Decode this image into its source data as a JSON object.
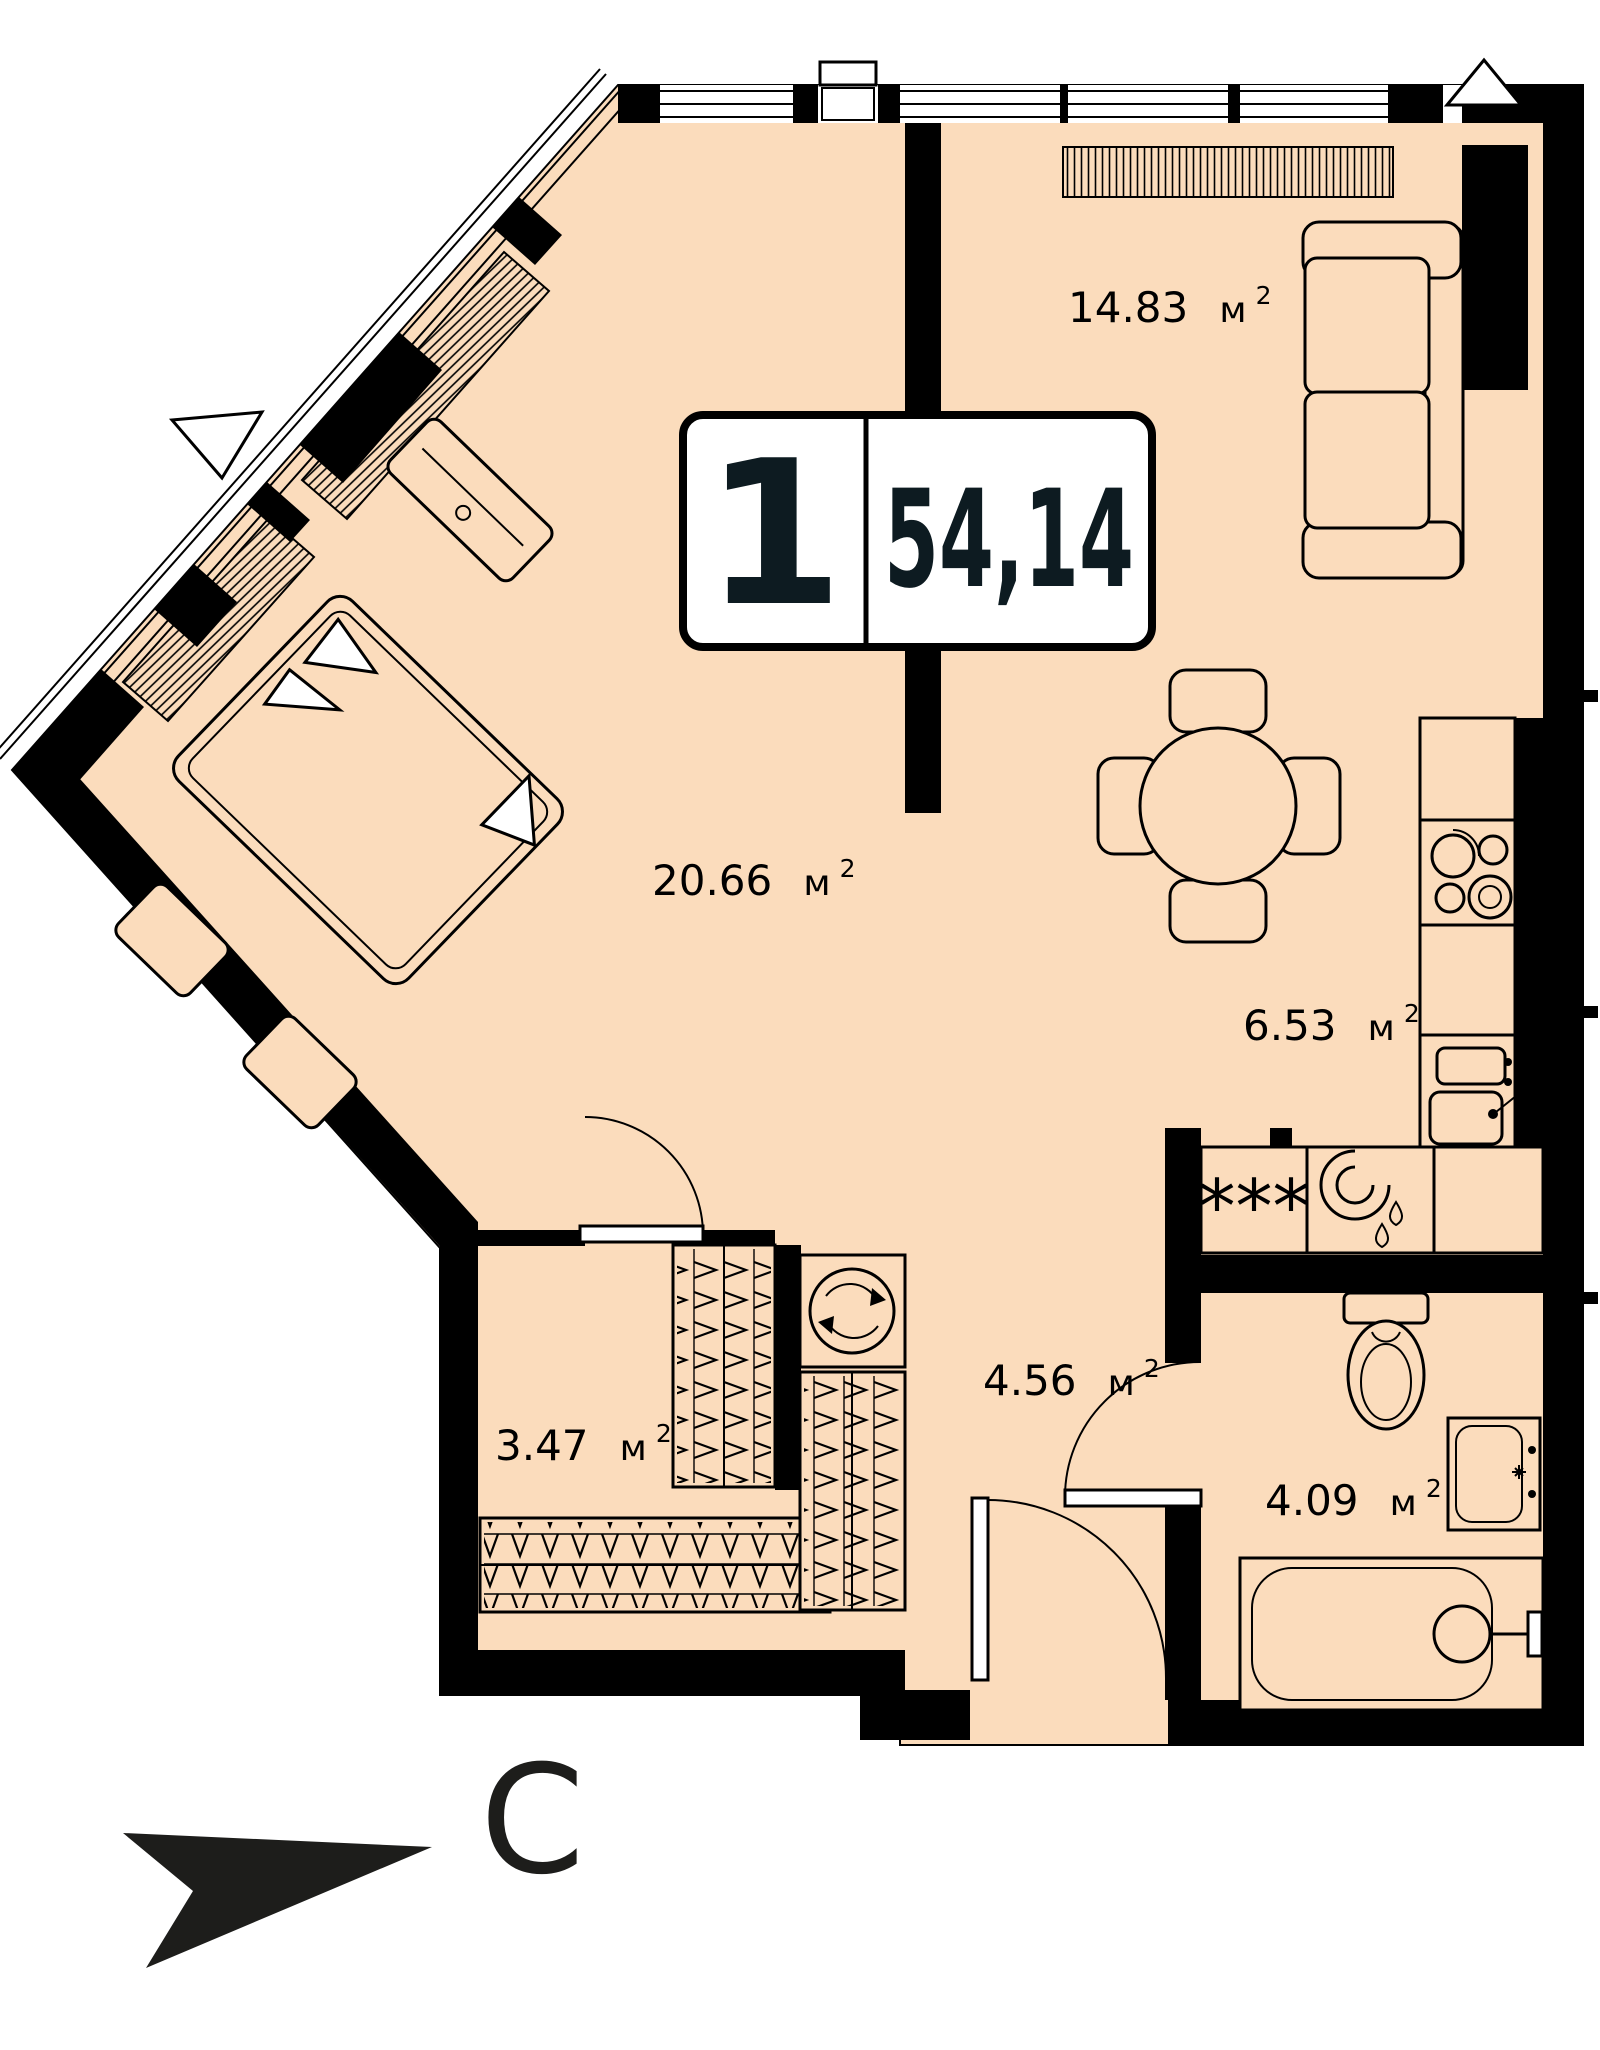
{
  "plan_title": "1-room apartment floor plan",
  "badge": {
    "rooms_count": "1",
    "total_area": "54,14"
  },
  "unit": {
    "symbol": "м",
    "power": "2"
  },
  "rooms": {
    "living": {
      "area": "14.83"
    },
    "bedroom": {
      "area": "20.66"
    },
    "kitchen": {
      "area": "6.53"
    },
    "hallway": {
      "area": "4.56"
    },
    "wardrobe": {
      "area": "3.47"
    },
    "bathroom": {
      "area": "4.09"
    }
  },
  "compass": {
    "north_label": "С"
  },
  "symbols": {
    "washing_machine_stars": "***"
  },
  "colors": {
    "floor": "#fbdcbc",
    "wall": "#000000",
    "label_text": "#000000",
    "badge_text": "#0d1b21",
    "background": "#ffffff"
  }
}
